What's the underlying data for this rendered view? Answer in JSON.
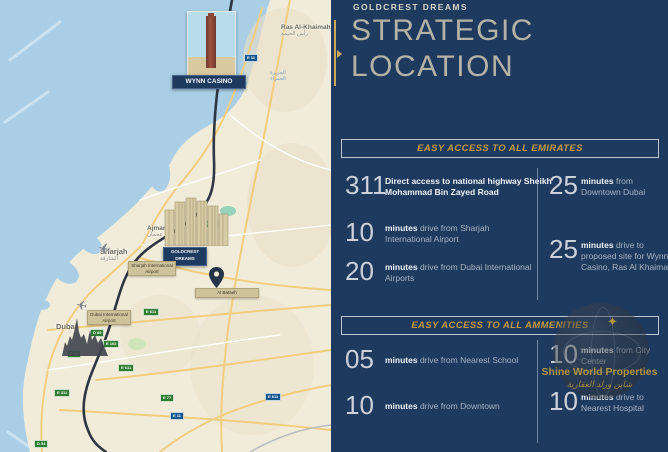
{
  "header": {
    "brand": "GOLDCREST DREAMS",
    "title_line1": "STRATEGIC",
    "title_line2": "LOCATION"
  },
  "sections": [
    {
      "title": "EASY ACCESS TO ALL EMIRATES",
      "left": [
        {
          "number": "311",
          "bold": "Direct access to national highway Sheikh Mohammad Bin Zayed Road",
          "rest": ""
        },
        {
          "number": "10",
          "bold": "minutes",
          "rest": " drive from Sharjah International Airport"
        },
        {
          "number": "20",
          "bold": "minutes",
          "rest": " drive from Dubai International Airports"
        }
      ],
      "right": [
        {
          "number": "25",
          "bold": "minutes",
          "rest": " from Downtown Dubai"
        },
        {
          "number": "25",
          "bold": "minutes",
          "rest": " drive to proposed site for Wynn Casino, Ras Al Khaimah"
        }
      ]
    },
    {
      "title": "EASY ACCESS TO ALL AMMENITIES",
      "left": [
        {
          "number": "05",
          "bold": "minutes",
          "rest": " drive from Nearest School"
        },
        {
          "number": "10",
          "bold": "minutes",
          "rest": " drive from Downtown"
        }
      ],
      "right": [
        {
          "number": "10",
          "bold": "minutes",
          "rest": " from City Center"
        },
        {
          "number": "10",
          "bold": "minutes",
          "rest": " drive to Nearest Hospital"
        }
      ]
    }
  ],
  "map": {
    "wynn_label": "WYNN CASINO",
    "goldcrest_label_line1": "GOLDCREST",
    "goldcrest_label_line2": "DREAMS",
    "cities": {
      "rak": "Ras Al-Khaimah",
      "rak_ar": "رأس الخيمة",
      "ajman": "Ajman",
      "ajman_ar": "عجمان",
      "sharjah": "Sharjah",
      "sharjah_ar": "الشارقة",
      "dubai": "Dubai"
    },
    "airports": {
      "sharjah": "Sharjah International Airport",
      "dubai": "Dubai International Airport"
    },
    "pin_label": "Al Bataeh",
    "coast_label_ar": "الجزيرة الحمراء",
    "shields": [
      {
        "label": "E 11"
      },
      {
        "label": "E 311"
      },
      {
        "label": "E 611"
      },
      {
        "label": "D 89"
      },
      {
        "label": "E 44"
      },
      {
        "label": "E 102"
      },
      {
        "label": "E 311"
      },
      {
        "label": "E 611"
      },
      {
        "label": "E 77"
      },
      {
        "label": "E 11"
      },
      {
        "label": "E 611"
      },
      {
        "label": "D 54"
      }
    ]
  },
  "watermark": {
    "line1": "Shine World Properties",
    "line2": "شاين ورلد العقارية"
  },
  "colors": {
    "panel_navy": "#1e3a5f",
    "gold_accent": "#c49a3c",
    "map_water": "#a9cee6",
    "map_land": "#f1ecda",
    "highway_dark": "#2d3642"
  }
}
